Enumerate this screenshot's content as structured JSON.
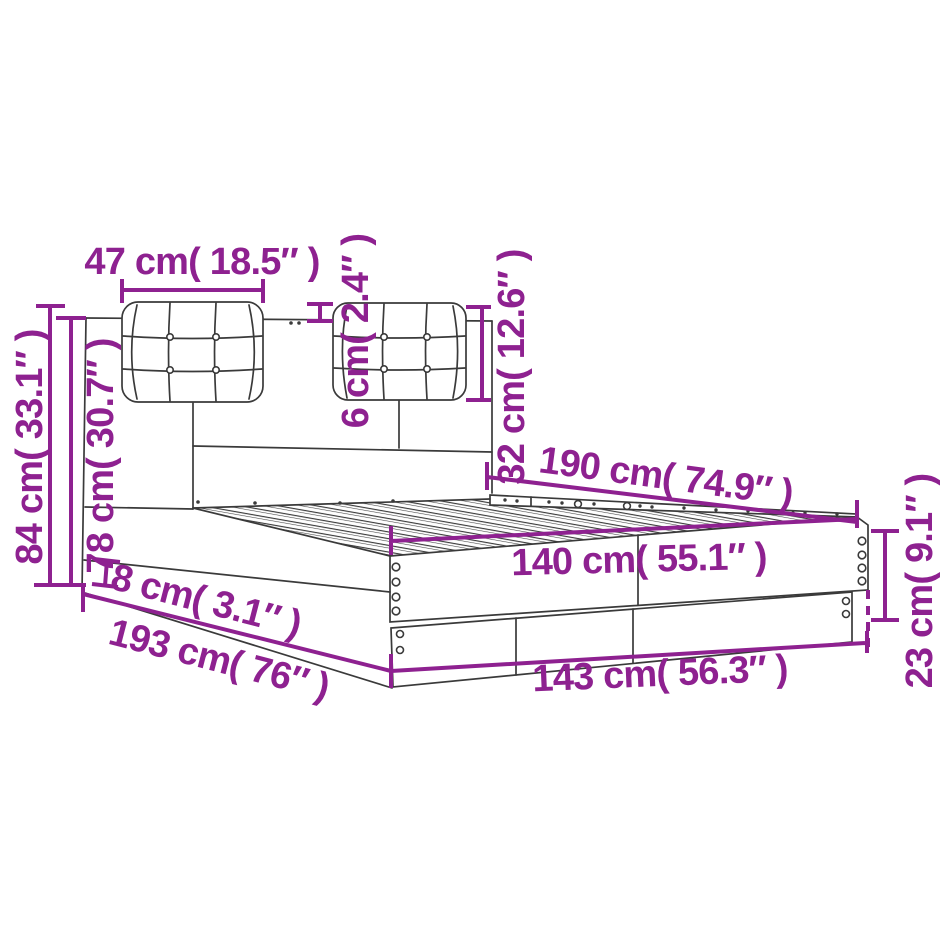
{
  "diagram": {
    "type": "product-dimension-diagram",
    "subject": "bed-frame-with-headboard-and-two-tufted-cushions",
    "accent_color": "#8e2190",
    "outline_color": "#3a3a3a",
    "background_color": "#ffffff",
    "labels": {
      "cushion_width": "47 cm( 18.5″ )",
      "cushion_thickness": "6 cm( 2.4″ )",
      "cushion_height": "32 cm( 12.6″ )",
      "total_height": "84 cm( 33.1″ )",
      "headboard_height": "78 cm( 30.7″ )",
      "slat_length": "190 cm( 74.9″ )",
      "slat_width": "140 cm( 55.1″ )",
      "base_rail_height": "8 cm( 3.1″ )",
      "total_length": "193 cm( 76″ )",
      "total_width": "143 cm( 56.3″ )",
      "frame_height": "23 cm( 9.1″ )"
    }
  }
}
